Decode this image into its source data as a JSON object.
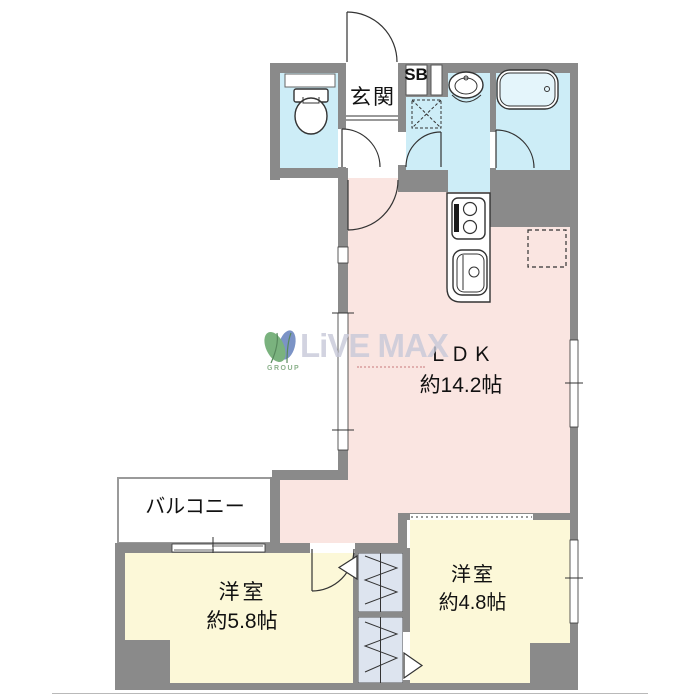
{
  "floorplan": {
    "labels": {
      "entrance": "玄関",
      "shoe_box": "SB",
      "ldk": "ＬＤＫ",
      "ldk_size": "約14.2帖",
      "balcony": "バルコニー",
      "bedroom_left": "洋室",
      "bedroom_left_size": "約5.8帖",
      "bedroom_right": "洋室",
      "bedroom_right_size": "約4.8帖"
    },
    "watermark": {
      "brand": "LiVE MAX",
      "sub": "GROUP"
    },
    "colors": {
      "wall": "#8a8a8a",
      "wet_area_floor": "#cdedf7",
      "ldk_floor": "#fae5e1",
      "bedroom_floor": "#fcf8d8",
      "closet_floor": "#dde4ef",
      "watermark_text": "#c7c9d9",
      "watermark_leaf_green": "#5aa05f",
      "watermark_leaf_blue": "#5b79b8"
    },
    "fixtures": [
      "toilet",
      "washbasin",
      "bathtub",
      "kitchen-stove",
      "kitchen-sink",
      "washing-machine-space",
      "refrigerator-space",
      "closet-upper",
      "closet-lower"
    ]
  }
}
